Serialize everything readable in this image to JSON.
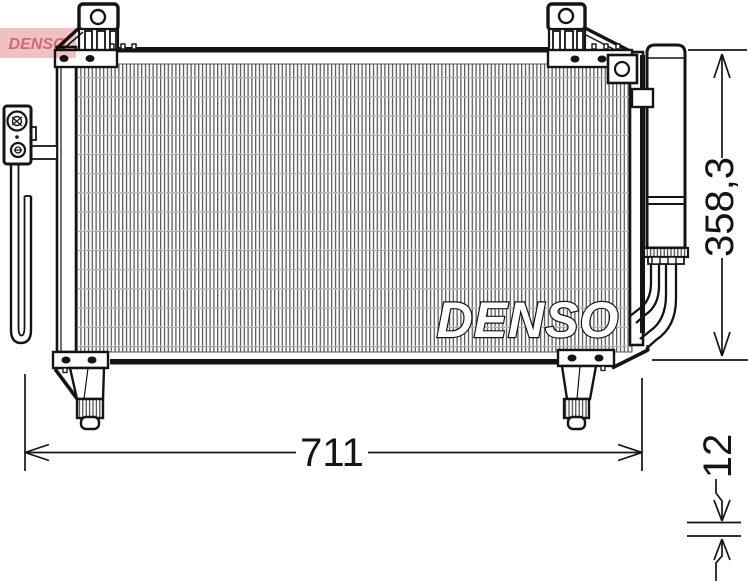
{
  "diagram": {
    "center_watermark": "DENSO",
    "corner_logo": "DENSO",
    "dimensions": {
      "overall_width": "711",
      "overall_height": "358,3",
      "core_depth": "12"
    },
    "colors": {
      "line": "#141414",
      "fin_line": "#4d4d4d",
      "corner_logo_bg": "#f0c0c3",
      "corner_logo_text": "#dc8d96"
    }
  }
}
